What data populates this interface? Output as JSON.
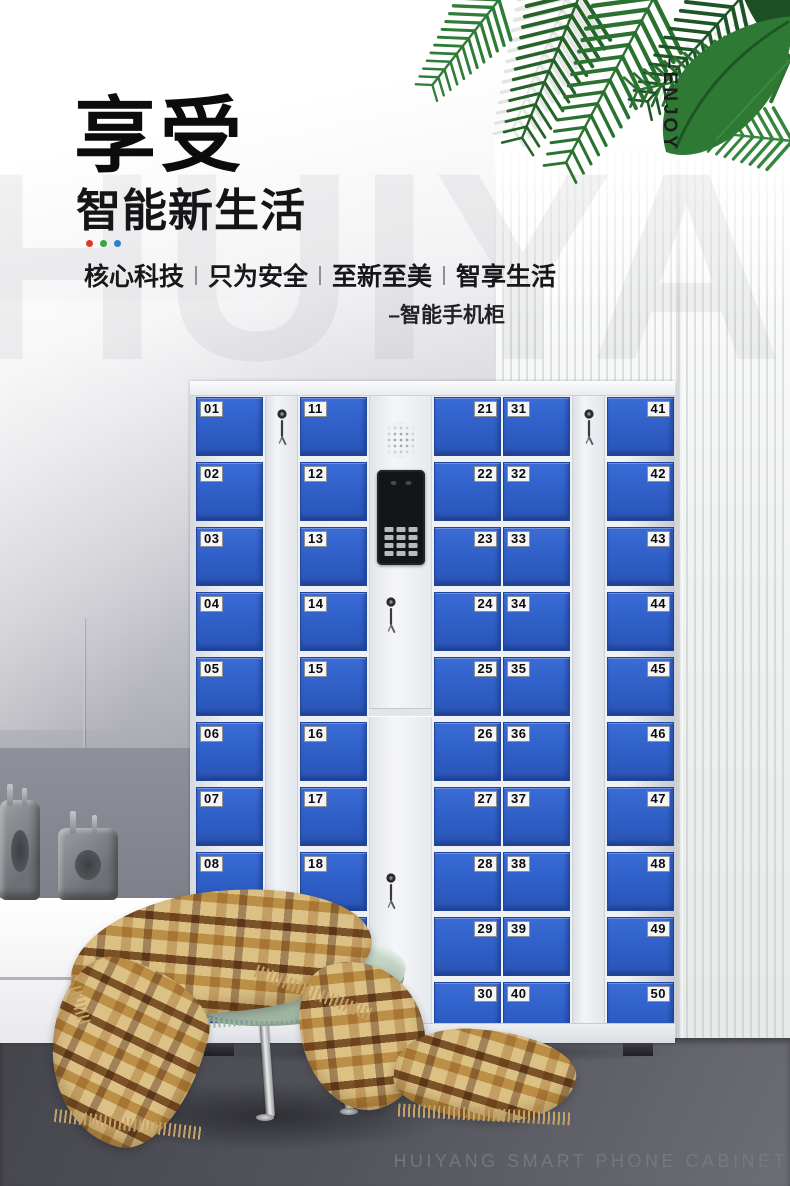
{
  "hero": {
    "title": "享受",
    "subtitle": "智能新生活",
    "accent_dots": [
      "#d93a2b",
      "#3aa344",
      "#2d7fc1"
    ],
    "slogans": [
      "核心科技",
      "只为安全",
      "至新至美",
      "智享生活"
    ],
    "tagline": "–智能手机柜",
    "vertical_text": "–ENJOY",
    "watermark": "HUIYANG"
  },
  "cabinet": {
    "door_color": "#2e5ec6",
    "frame_color": "#eef0f4",
    "columns": [
      {
        "type": "lockers",
        "label_side": "left",
        "numbers": [
          "01",
          "02",
          "03",
          "04",
          "05",
          "06",
          "07",
          "08",
          "09",
          "10"
        ]
      },
      {
        "type": "lock"
      },
      {
        "type": "lockers",
        "label_side": "left",
        "numbers": [
          "11",
          "12",
          "13",
          "14",
          "15",
          "16",
          "17",
          "18",
          "19",
          "20"
        ]
      },
      {
        "type": "control"
      },
      {
        "type": "lockers",
        "label_side": "right",
        "numbers": [
          "21",
          "22",
          "23",
          "24",
          "25",
          "26",
          "27",
          "28",
          "29",
          "30"
        ]
      },
      {
        "type": "lockers",
        "label_side": "left",
        "numbers": [
          "31",
          "32",
          "33",
          "34",
          "35",
          "36",
          "37",
          "38",
          "39",
          "40"
        ]
      },
      {
        "type": "lock"
      },
      {
        "type": "lockers",
        "label_side": "right",
        "numbers": [
          "41",
          "42",
          "43",
          "44",
          "45",
          "46",
          "47",
          "48",
          "49",
          "50"
        ]
      }
    ],
    "icons": [
      "speaker-grille",
      "camera-screen",
      "numeric-keypad",
      "key-lock"
    ]
  },
  "scene": {
    "leaf_color": "#2b7231",
    "floor_color": "#53535b",
    "blanket_colors": [
      "#ead9b0",
      "#d0ab67",
      "#784c22"
    ],
    "seat_color": "#b7cbba"
  },
  "footer": {
    "caption": "HUIYANG SMART PHONE CABINET"
  }
}
